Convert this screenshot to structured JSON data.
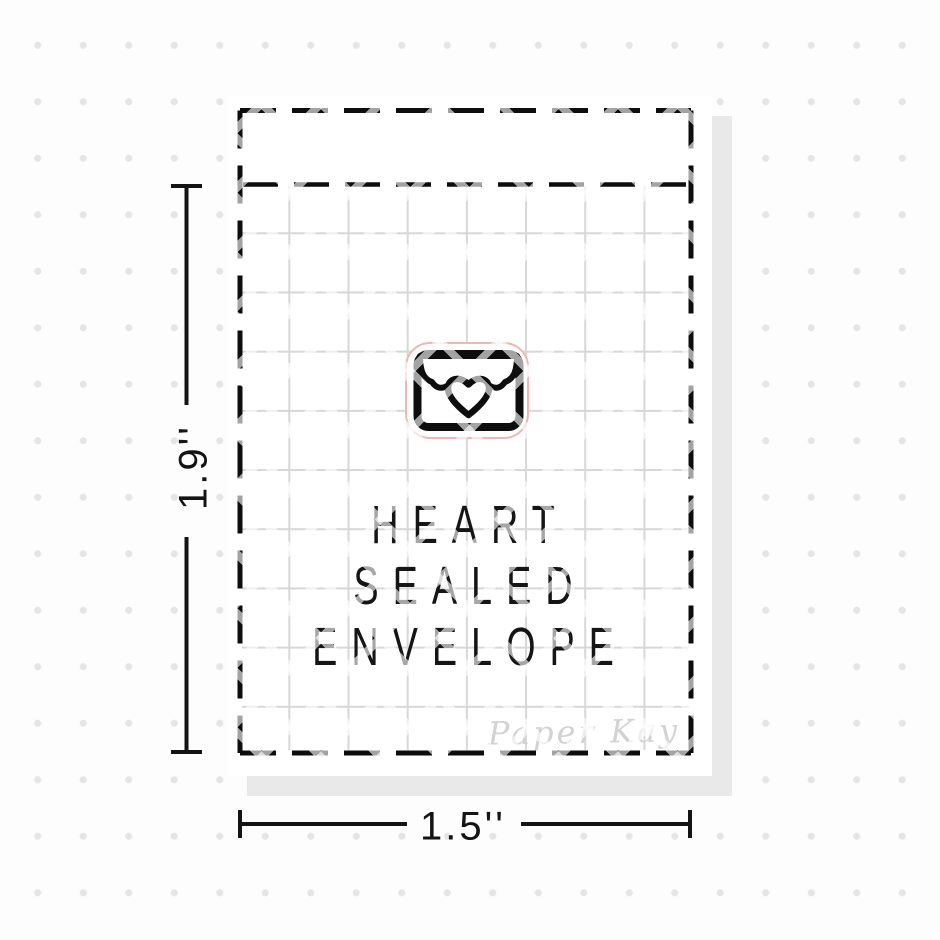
{
  "product_image": {
    "sticker": {
      "icon": "heart-sealed-envelope-icon",
      "title_lines": [
        "HEART",
        "SEALED",
        "ENVELOPE"
      ],
      "watermark": "Paper Kay"
    },
    "dimensions": {
      "height_label": "1.9''",
      "width_label": "1.5''"
    },
    "colors": {
      "ink_black": "#0d0d0d",
      "grid_line_gray": "#d7d7d7",
      "background_dot_gray": "#e5e5e5",
      "shadow_gray": "#e9e9e9",
      "sticker_cut_line_pink": "#f0b6b3",
      "watermark_gray": "#d2d2d2"
    }
  }
}
